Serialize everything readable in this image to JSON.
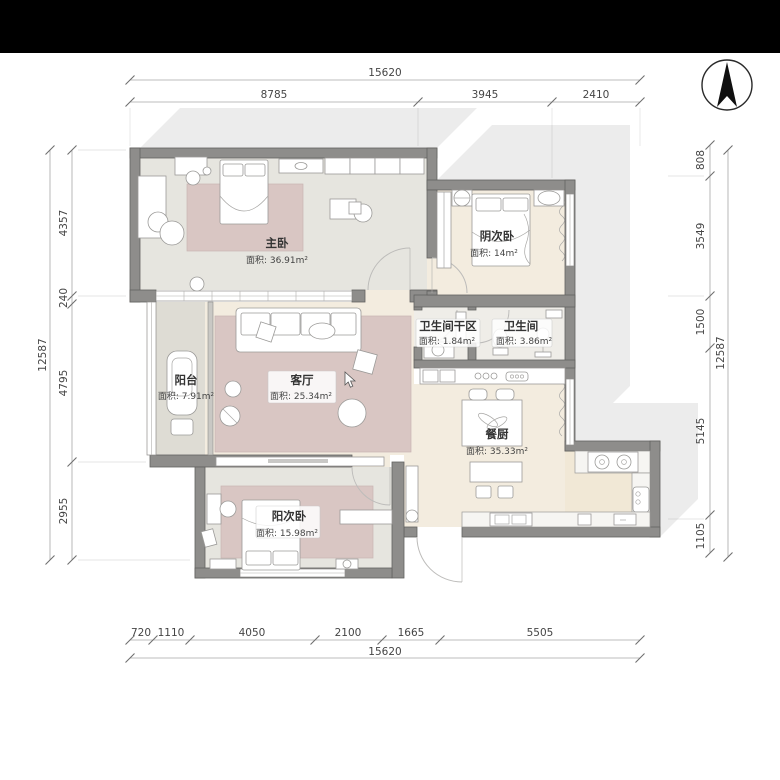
{
  "page": {
    "top_bar_color": "#000000",
    "background": "#ffffff"
  },
  "palette": {
    "wall": "#8e8d8b",
    "wall_stroke": "#636260",
    "floor_grey": "#e6e5df",
    "floor_beige": "#f3ecdf",
    "floor_kitchen": "#f1e8d6",
    "floor_balcony": "#dedcd4",
    "floor_bath": "#efede8",
    "rug_pink": "#d9c6c3",
    "furniture": "#ffffff",
    "dim_text": "#454545",
    "shadow": "#8f8f8f"
  },
  "compass": {
    "label": "north-arrow"
  },
  "dimensions": {
    "top": {
      "total": "15620",
      "segments": [
        "8785",
        "3945",
        "2410"
      ]
    },
    "bottom": {
      "total": "15620",
      "segments": [
        "720",
        "1110",
        "4050",
        "2100",
        "1665",
        "5505"
      ]
    },
    "left": {
      "total": "12587",
      "segments": [
        "4357",
        "240",
        "4795",
        "2955"
      ]
    },
    "right": {
      "total": "12587",
      "segments": [
        "808",
        "3549",
        "1500",
        "5145",
        "1105"
      ]
    }
  },
  "rooms": {
    "master": {
      "name": "主卧",
      "area": "面积: 36.91m²"
    },
    "north_bedroom": {
      "name": "阴次卧",
      "area": "面积: 14m²"
    },
    "bath_dry": {
      "name": "卫生间干区",
      "area": "面积: 1.84m²"
    },
    "bathroom": {
      "name": "卫生间",
      "area": "面积: 3.86m²"
    },
    "living": {
      "name": "客厅",
      "area": "面积: 25.34m²"
    },
    "balcony": {
      "name": "阳台",
      "area": "面积: 7.91m²"
    },
    "dining_kitchen": {
      "name": "餐厨",
      "area": "面积: 35.33m²"
    },
    "south_bedroom": {
      "name": "阳次卧",
      "area": "面积: 15.98m²"
    }
  }
}
